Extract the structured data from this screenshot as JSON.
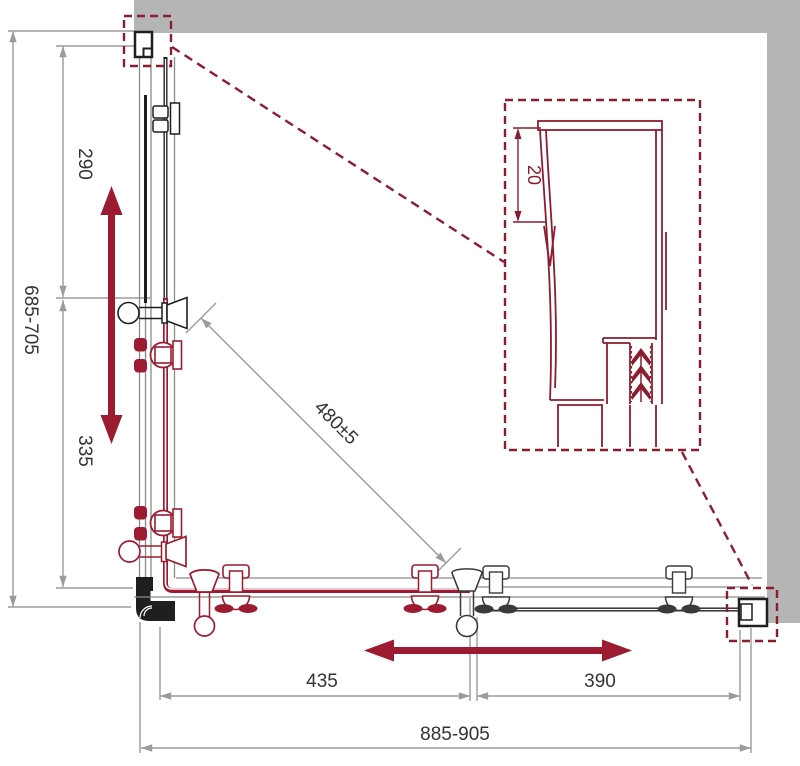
{
  "title": "corner shower enclosure installation drawing",
  "dims": {
    "left_total": "685-705",
    "left_upper": "290",
    "left_lower": "335",
    "diagonal": "480±5",
    "detail_depth": "20",
    "bottom_left": "435",
    "bottom_right": "390",
    "bottom_total": "885-905"
  },
  "icons": {
    "slide_vertical": "double-arrow-vertical",
    "slide_horizontal": "double-arrow-horizontal"
  },
  "theme": {
    "red": "#9d1b30",
    "dark_red": "#8c1d2f",
    "wall_gray": "#b5b5b5",
    "line_gray": "#9b9b9b",
    "draw_gray": "#8a8a8a",
    "black": "#1f1f1f",
    "hw_gray": "#3a3a3a",
    "text": "#333333",
    "bg": "#ffffff"
  }
}
